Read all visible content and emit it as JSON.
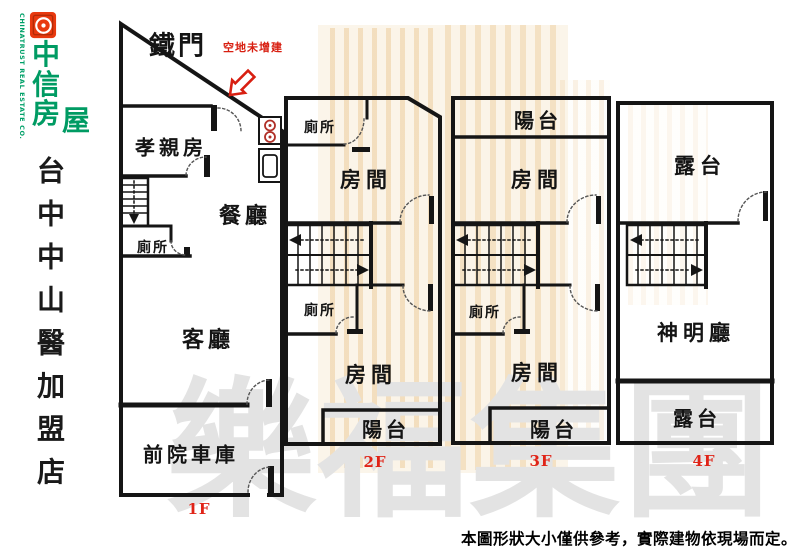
{
  "brand": {
    "logo_chars": [
      "中",
      "信",
      "房",
      "屋"
    ],
    "logo_english": "CHINATRUST REAL ESTATE CO.",
    "store_name": "台中中山醫加盟店",
    "logo_green": "#009b63",
    "logo_red": "#e8390f"
  },
  "plan": {
    "gate_label": "鐵門",
    "vacant_note": "空地未增建",
    "note_red": "#d81f11",
    "floor_label_red": "#e02317",
    "floors": {
      "f1": {
        "label": "1F",
        "parents_room": "孝親房",
        "dining": "餐廳",
        "toilet": "廁所",
        "living": "客廳",
        "garage": "前院車庫"
      },
      "f2": {
        "label": "2F",
        "toilet_top": "廁所",
        "room_top": "房間",
        "toilet_mid": "廁所",
        "room_bottom": "房間",
        "balcony": "陽台"
      },
      "f3": {
        "label": "3F",
        "balcony_top": "陽台",
        "room_top": "房間",
        "toilet_mid": "廁所",
        "room_bottom": "房間",
        "balcony_bottom": "陽台"
      },
      "f4": {
        "label": "4F",
        "terrace_top": "露台",
        "shrine": "神明廳",
        "terrace_bottom": "露台"
      }
    }
  },
  "watermark": {
    "group_name": "樂福集團"
  },
  "footer": {
    "disclaimer": "本圖形狀大小僅供參考，實際建物依現場而定。"
  }
}
